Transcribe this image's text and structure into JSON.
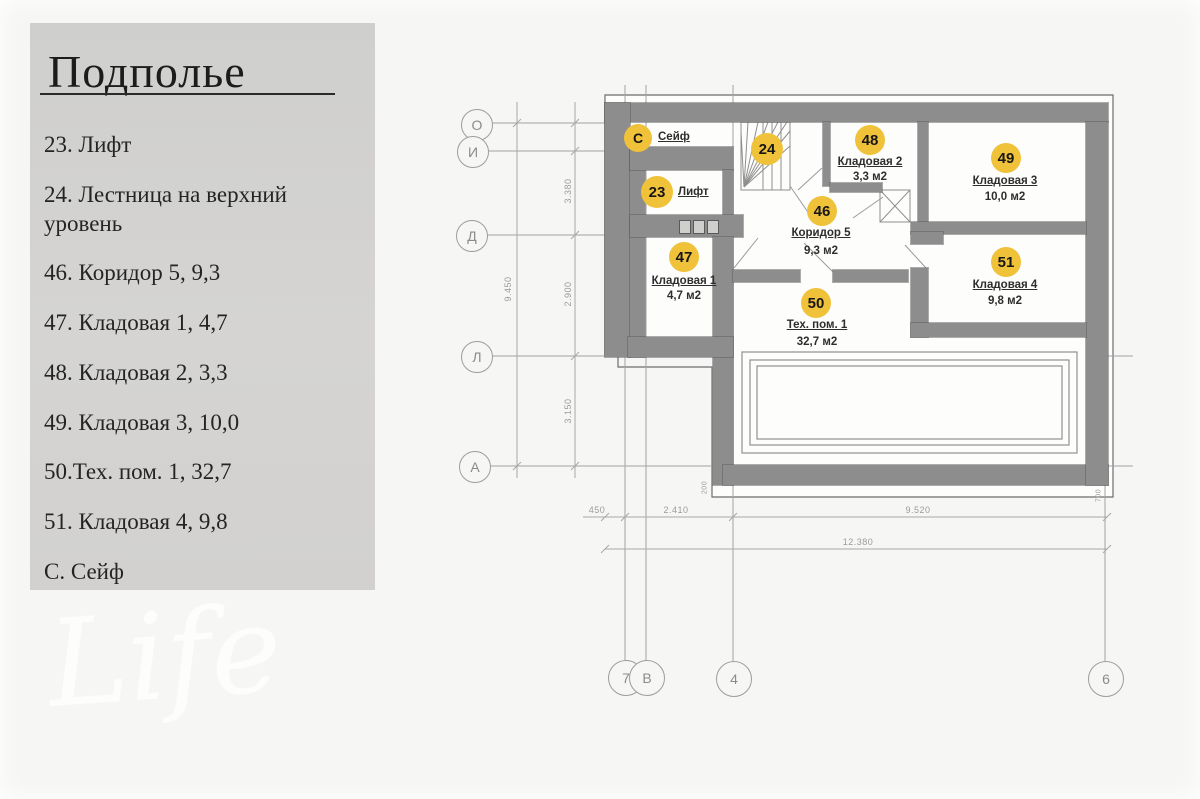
{
  "legend": {
    "title": "Подполье",
    "items": [
      "23. Лифт",
      "24. Лестница на верхний уровень",
      "46. Коридор 5, 9,3",
      "47. Кладовая 1, 4,7",
      "48. Кладовая 2, 3,3",
      "49. Кладовая 3, 10,0",
      "50.Тех. пом. 1, 32,7",
      "51. Кладовая 4, 9,8",
      "С. Сейф"
    ]
  },
  "watermark": {
    "text": "Life"
  },
  "plan": {
    "rooms": {
      "safe": {
        "badge": "С",
        "name": "Сейф"
      },
      "stair": {
        "badge": "24"
      },
      "lift": {
        "badge": "23",
        "name": "Лифт"
      },
      "k2": {
        "badge": "48",
        "name": "Кладовая 2",
        "area": "3,3 м2"
      },
      "k3": {
        "badge": "49",
        "name": "Кладовая 3",
        "area": "10,0 м2"
      },
      "corridor": {
        "badge": "46",
        "name": "Коридор 5",
        "area": "9,3 м2"
      },
      "k1": {
        "badge": "47",
        "name": "Кладовая 1",
        "area": "4,7 м2"
      },
      "k4": {
        "badge": "51",
        "name": "Кладовая 4",
        "area": "9,8 м2"
      },
      "tech": {
        "badge": "50",
        "name": "Тех. пом. 1",
        "area": "32,7 м2"
      }
    },
    "axes_left": [
      "О",
      "И",
      "Д",
      "Л",
      "А"
    ],
    "axes_bottom": [
      "7",
      "В",
      "4",
      "6"
    ],
    "dims": {
      "total_h": "9.450",
      "seg_top": "3.380",
      "seg_mid": "2.900",
      "seg_bot": "3.150",
      "b450": "450",
      "b2410": "2.410",
      "b9520": "9.520",
      "total_w": "12.380",
      "n200": "200",
      "n700": "700"
    }
  },
  "colors": {
    "badge": "#F0C23A",
    "wall": "#8D8D8D",
    "panel": "#D2D1CF"
  }
}
